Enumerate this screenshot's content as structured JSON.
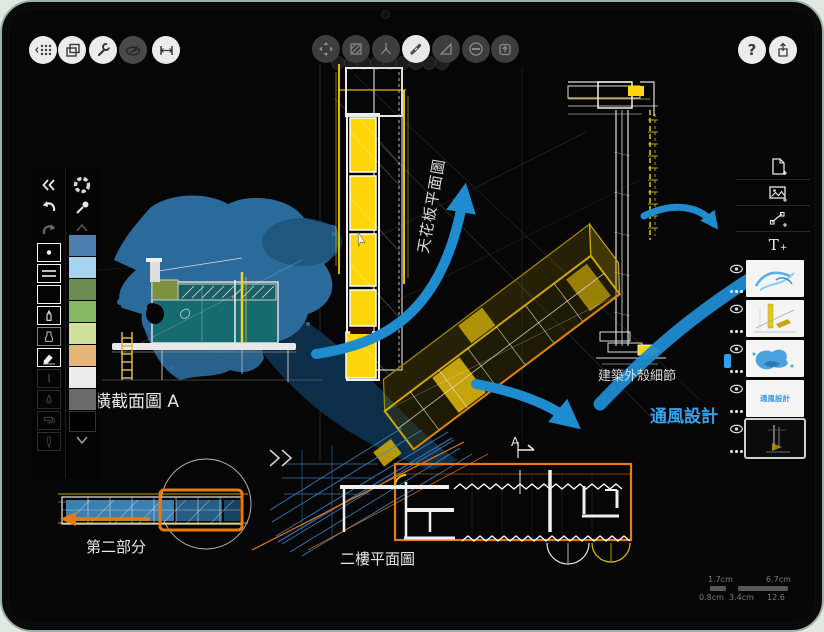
{
  "top_toolbar": {
    "left_buttons": [
      {
        "name": "grid-menu",
        "icon": "grid-icon"
      },
      {
        "name": "pages",
        "icon": "pages-icon"
      },
      {
        "name": "settings",
        "icon": "wrench-icon"
      },
      {
        "name": "navigator",
        "icon": "compass-icon"
      },
      {
        "name": "measure",
        "icon": "measure-icon"
      }
    ],
    "tool_ring": [
      {
        "name": "move-tool",
        "icon": "move-arrows-icon",
        "active": false
      },
      {
        "name": "fill-tool",
        "icon": "hatch-square-icon",
        "active": false
      },
      {
        "name": "wire-tool",
        "icon": "nib-lines-icon",
        "active": false
      },
      {
        "name": "pen-tool",
        "icon": "marker-pen-icon",
        "active": true
      },
      {
        "name": "shape-guide-tool",
        "icon": "triangle-icon",
        "active": false
      },
      {
        "name": "eraser-tool",
        "icon": "circle-minus-icon",
        "active": false
      },
      {
        "name": "import-tool",
        "icon": "arrow-up-box-icon",
        "active": false
      }
    ],
    "help_label": "?",
    "share": {
      "name": "share",
      "icon": "share-icon"
    }
  },
  "left_panel": {
    "collapse_icon": "chevrons-left-icon",
    "undo_icon": "undo-arrow-icon",
    "redo_icon": "redo-arrow-icon",
    "color_wheel_icon": "color-wheel-icon",
    "eyedropper_icon": "eyedropper-icon",
    "tools": [
      {
        "name": "dot-preset",
        "state": "normal"
      },
      {
        "name": "line-preset",
        "state": "normal"
      },
      {
        "name": "blank-preset",
        "state": "normal"
      },
      {
        "name": "pen",
        "state": "selected"
      },
      {
        "name": "marker",
        "state": "normal"
      },
      {
        "name": "eraser",
        "state": "selected"
      },
      {
        "name": "fineliner",
        "state": "dimmed"
      },
      {
        "name": "fountain-pen",
        "state": "dimmed"
      },
      {
        "name": "paint-roller",
        "state": "dimmed"
      },
      {
        "name": "airbrush",
        "state": "dimmed"
      }
    ],
    "swatches": [
      {
        "name": "blue",
        "hex": "#4c7fb0"
      },
      {
        "name": "light-blue",
        "hex": "#a6d3f0"
      },
      {
        "name": "olive-green",
        "hex": "#6d8c55"
      },
      {
        "name": "green",
        "hex": "#86b763"
      },
      {
        "name": "pale-green",
        "hex": "#cfe09b"
      },
      {
        "name": "tan",
        "hex": "#e5b477"
      },
      {
        "name": "white",
        "hex": "#ececec"
      },
      {
        "name": "gray",
        "hex": "#6b6b6b"
      },
      {
        "name": "black",
        "hex": "#000000"
      }
    ]
  },
  "right_panel": {
    "add_buttons": [
      {
        "name": "new-page",
        "icon": "page-plus-icon"
      },
      {
        "name": "add-image",
        "icon": "image-plus-icon"
      },
      {
        "name": "add-guide",
        "icon": "transform-plus-icon"
      },
      {
        "name": "add-text",
        "icon": "text-plus-icon",
        "label": "T"
      }
    ],
    "layers": [
      {
        "name": "arrows-layer",
        "visible": true,
        "selected": false
      },
      {
        "name": "sketch-layer",
        "visible": true,
        "selected": false
      },
      {
        "name": "wash-layer",
        "visible": true,
        "selected": false
      },
      {
        "name": "text-layer",
        "visible": true,
        "selected": false,
        "thumbnail_text": "通風設計"
      },
      {
        "name": "background-layer",
        "visible": true,
        "selected": true
      }
    ]
  },
  "canvas": {
    "labels": {
      "cross_section": "橫截面圖 A",
      "ceiling_plan": "天花板平面圖",
      "shell_detail": "建築外殼細節",
      "ventilation": "通風設計",
      "part_two": "第二部分",
      "second_floor_plan": "二樓平面圖",
      "section_marker": "A"
    },
    "scale_bar": {
      "upper_left": "1.7cm",
      "upper_right": "6.7cm",
      "lower_left": "0.8cm",
      "lower_mid": "3.4cm",
      "lower_right": "12.6"
    },
    "colors": {
      "arrow_blue": "#1f8cd0",
      "highlight_yellow": "#ffd60a",
      "accent_orange": "#e87a10",
      "wash_blue": "#2b6b9b",
      "section_teal": "#156b6f",
      "label_blue": "#37a2ee"
    }
  }
}
